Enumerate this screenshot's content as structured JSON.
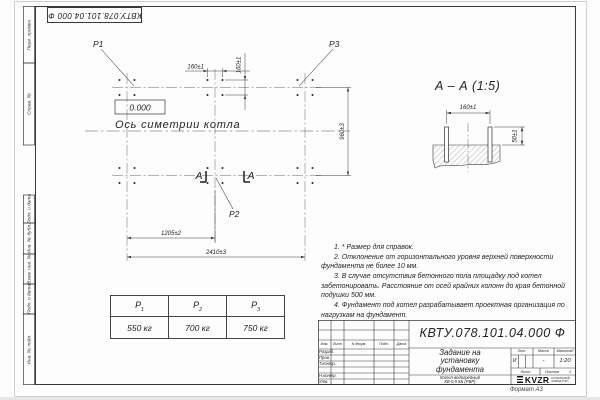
{
  "stamp": {
    "code_flipped": "КВТУ.078.101.04.000  Ф"
  },
  "margin": {
    "fields": [
      "Перв. примен.",
      "Справ. №",
      "Подп. и дата",
      "Инв. № дубл.",
      "Взам. инв. №",
      "Подп. и дата",
      "Инв. № подл."
    ],
    "format_note": "Формат А3"
  },
  "plan": {
    "label_p1": "P1",
    "label_p2": "P2",
    "label_p3": "P3",
    "elevation": "0.000",
    "axis_caption": "Ось симетрии котла",
    "section_letter_left": "А",
    "section_letter_right": "А",
    "dim_bolt_spacing_h": "160±1",
    "dim_bolt_spacing_v": "160±1",
    "dim_rows": "960±3",
    "dim_half": "1205±2",
    "dim_full": "2410±3"
  },
  "section": {
    "title": "А – А (1:5)",
    "dim_spacing": "160±1",
    "dim_height": "50±1"
  },
  "loads": {
    "columns": [
      {
        "name": "P",
        "sub": "1",
        "value": "550 кг"
      },
      {
        "name": "P",
        "sub": "2",
        "value": "700 кг"
      },
      {
        "name": "P",
        "sub": "3",
        "value": "750 кг"
      }
    ]
  },
  "notes": {
    "items": [
      "1. * Размер для справок.",
      "2. Отклонение от горизонтального уровня верхней поверхности фундамента не более 10 мм.",
      "3. В случае отсутствия бетонного пола площадку под котел забетонировать. Расстояние от осей крайних колонн до края бетонной подушки 500 мм.",
      "4. Фундамент под котел разрабатывает проектная организация по нагрузкам на фундамент."
    ]
  },
  "title_block": {
    "designation": "КВТУ.078.101.04.000 Ф",
    "doc_title_lines": [
      "Задание на",
      "установку",
      "фундамента"
    ],
    "product_lines": [
      "Котел водогрейный",
      "КВ-0,9 КБ (РВР)"
    ],
    "rev_header": [
      "Изм.",
      "Лист",
      "N докум.",
      "Подп.",
      "Дата"
    ],
    "sign_rows": [
      "Разраб.",
      "Пров.",
      "Т.контр.",
      "Н.контр.",
      "Утв."
    ],
    "lit_label": "Лит.",
    "mass_label": "Масса",
    "scale_label": "Масштаб",
    "lit_value": "И",
    "mass_value": "-",
    "scale_value": "1:20",
    "sheet_label": "Лист",
    "sheets_label": "Листов",
    "sheets_value": "1",
    "logo_text": "KVZR",
    "logo_caption_lines": [
      "КОТЕЛЬНЫЙ",
      "ЗАВОД РЭП"
    ]
  }
}
